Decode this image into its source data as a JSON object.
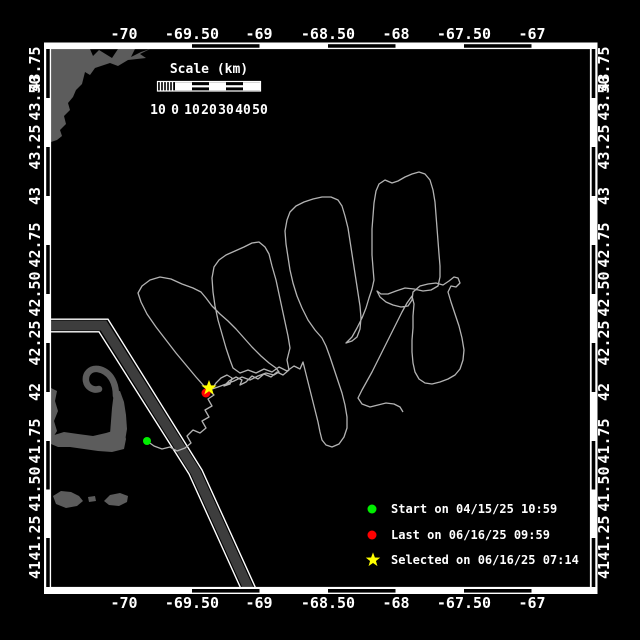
{
  "figure": {
    "bg": "#000000",
    "frame_color": "#ffffff",
    "axes": {
      "lon_labels": [
        {
          "text": "-70",
          "x": 124
        },
        {
          "text": "-69.50",
          "x": 192
        },
        {
          "text": "-69",
          "x": 259
        },
        {
          "text": "-68.50",
          "x": 328
        },
        {
          "text": "-68",
          "x": 396
        },
        {
          "text": "-67.50",
          "x": 464
        },
        {
          "text": "-67",
          "x": 532
        }
      ],
      "lat_labels": [
        {
          "text": "43.75",
          "y": 69
        },
        {
          "text": "43.50",
          "y": 98
        },
        {
          "text": "43.25",
          "y": 147
        },
        {
          "text": "43",
          "y": 196
        },
        {
          "text": "42.75",
          "y": 245
        },
        {
          "text": "42.50",
          "y": 294
        },
        {
          "text": "42.25",
          "y": 343
        },
        {
          "text": "42",
          "y": 392
        },
        {
          "text": "41.75",
          "y": 441
        },
        {
          "text": "41.50",
          "y": 489
        },
        {
          "text": "41.25",
          "y": 538
        },
        {
          "text": "41",
          "y": 570
        }
      ]
    },
    "scalebar": {
      "title": "Scale (km)",
      "tick_labels": [
        {
          "text": "10",
          "x": 158
        },
        {
          "text": "0",
          "x": 175
        },
        {
          "text": "10",
          "x": 192
        },
        {
          "text": "20",
          "x": 209
        },
        {
          "text": "30",
          "x": 226
        },
        {
          "text": "40",
          "x": 243
        },
        {
          "text": "50",
          "x": 260
        }
      ]
    },
    "legend": {
      "items": [
        {
          "marker": "circle",
          "color": "#00ee00",
          "label": "Start on 04/15/25 10:59",
          "y": 509
        },
        {
          "marker": "circle",
          "color": "#ff0000",
          "label": "Last on 06/16/25 09:59",
          "y": 535
        },
        {
          "marker": "star",
          "color": "#ffff00",
          "label": "Selected on 06/16/25 07:14",
          "y": 560
        }
      ]
    }
  },
  "map": {
    "land_color": "#5c5c5c",
    "track_color": "#b3b3b3",
    "lane": {
      "edge_color": "#ffffff",
      "band_color": "#3d3d3d",
      "centerline_color": "#1c1c1c",
      "outer_d": "M 51 319.2 L 108 319.2 L 202 470 L 257 591",
      "inner_d": "M 51 331.8 L 99 331.8 L 189 474 L 242 591",
      "band_d": "M 51 325.5 L 103.5 325.5 L 195.5 472 L 249.5 591"
    },
    "land": {
      "maine": [
        [
          51,
          49
        ],
        [
          90,
          49
        ],
        [
          93,
          56
        ],
        [
          99,
          50
        ],
        [
          112,
          58
        ],
        [
          118,
          49
        ],
        [
          135,
          49
        ],
        [
          131,
          57
        ],
        [
          141,
          52
        ],
        [
          150,
          49
        ],
        [
          140,
          54
        ],
        [
          146,
          58
        ],
        [
          128,
          60
        ],
        [
          118,
          66
        ],
        [
          110,
          63
        ],
        [
          95,
          68
        ],
        [
          90,
          75
        ],
        [
          85,
          72
        ],
        [
          82,
          84
        ],
        [
          76,
          90
        ],
        [
          73,
          97
        ],
        [
          68,
          103
        ],
        [
          70,
          110
        ],
        [
          64,
          116
        ],
        [
          66,
          124
        ],
        [
          60,
          130
        ],
        [
          62,
          136
        ],
        [
          57,
          140
        ],
        [
          51,
          142
        ]
      ],
      "cape_bicep": [
        [
          51,
          436
        ],
        [
          64,
          432
        ],
        [
          78,
          434
        ],
        [
          93,
          436
        ],
        [
          106,
          433
        ],
        [
          116,
          430
        ],
        [
          124,
          431
        ],
        [
          126,
          439
        ],
        [
          124,
          449
        ],
        [
          112,
          452
        ],
        [
          98,
          451
        ],
        [
          84,
          449
        ],
        [
          70,
          447
        ],
        [
          58,
          447
        ],
        [
          51,
          444
        ]
      ],
      "cape_forearm": [
        [
          110,
          434
        ],
        [
          112,
          408
        ],
        [
          114,
          392
        ],
        [
          120,
          391
        ],
        [
          124,
          402
        ],
        [
          126,
          415
        ],
        [
          127,
          429
        ],
        [
          125,
          441
        ],
        [
          117,
          446
        ],
        [
          111,
          441
        ]
      ],
      "mainland_strip": [
        [
          51,
          388
        ],
        [
          57,
          391
        ],
        [
          55,
          401
        ],
        [
          58,
          411
        ],
        [
          54,
          421
        ],
        [
          57,
          431
        ],
        [
          52,
          439
        ],
        [
          51,
          439
        ]
      ],
      "marthas_vineyard": [
        [
          53,
          496
        ],
        [
          61,
          491
        ],
        [
          71,
          492
        ],
        [
          79,
          496
        ],
        [
          83,
          501
        ],
        [
          77,
          506
        ],
        [
          66,
          508
        ],
        [
          56,
          504
        ]
      ],
      "nantucket": [
        [
          104,
          501
        ],
        [
          110,
          495
        ],
        [
          120,
          493
        ],
        [
          128,
          496
        ],
        [
          127,
          502
        ],
        [
          119,
          506
        ],
        [
          109,
          505
        ]
      ],
      "small_isle": [
        [
          88,
          497
        ],
        [
          95,
          496
        ],
        [
          96,
          501
        ],
        [
          89,
          502
        ]
      ]
    },
    "cape_hook_d": "M 116,396 C 116,381 109,371 98,369 C 90,368 85,374 86,381 C 87,387 93,391 99,389",
    "track_points": [
      [
        147,
        441
      ],
      [
        154,
        446
      ],
      [
        162,
        449
      ],
      [
        170,
        447
      ],
      [
        177,
        451
      ],
      [
        185,
        448
      ],
      [
        191,
        443
      ],
      [
        187,
        436
      ],
      [
        193,
        430
      ],
      [
        200,
        433
      ],
      [
        206,
        428
      ],
      [
        202,
        421
      ],
      [
        209,
        417
      ],
      [
        205,
        410
      ],
      [
        212,
        406
      ],
      [
        208,
        399
      ],
      [
        214,
        395
      ],
      [
        210,
        391
      ],
      [
        204,
        386
      ],
      [
        196,
        377
      ],
      [
        186,
        365
      ],
      [
        176,
        353
      ],
      [
        166,
        340
      ],
      [
        156,
        327
      ],
      [
        147,
        314
      ],
      [
        141,
        302
      ],
      [
        138,
        293
      ],
      [
        142,
        286
      ],
      [
        150,
        280
      ],
      [
        160,
        277
      ],
      [
        171,
        279
      ],
      [
        182,
        284
      ],
      [
        193,
        288
      ],
      [
        201,
        292
      ],
      [
        206,
        298
      ],
      [
        212,
        306
      ],
      [
        220,
        314
      ],
      [
        228,
        321
      ],
      [
        236,
        329
      ],
      [
        244,
        338
      ],
      [
        252,
        347
      ],
      [
        261,
        356
      ],
      [
        269,
        363
      ],
      [
        276,
        368
      ],
      [
        279,
        372
      ],
      [
        274,
        375
      ],
      [
        266,
        373
      ],
      [
        258,
        376
      ],
      [
        250,
        380
      ],
      [
        242,
        377
      ],
      [
        234,
        381
      ],
      [
        226,
        384
      ],
      [
        218,
        387
      ],
      [
        212,
        389
      ],
      [
        216,
        383
      ],
      [
        221,
        378
      ],
      [
        227,
        375
      ],
      [
        232,
        378
      ],
      [
        230,
        384
      ],
      [
        224,
        386
      ],
      [
        229,
        381
      ],
      [
        236,
        377
      ],
      [
        242,
        380
      ],
      [
        240,
        385
      ],
      [
        246,
        382
      ],
      [
        252,
        376
      ],
      [
        258,
        379
      ],
      [
        264,
        374
      ],
      [
        271,
        377
      ],
      [
        277,
        372
      ],
      [
        283,
        375
      ],
      [
        289,
        370
      ],
      [
        287,
        360
      ],
      [
        290,
        348
      ],
      [
        288,
        336
      ],
      [
        285,
        322
      ],
      [
        282,
        308
      ],
      [
        279,
        294
      ],
      [
        276,
        280
      ],
      [
        272,
        266
      ],
      [
        269,
        254
      ],
      [
        265,
        247
      ],
      [
        259,
        242
      ],
      [
        252,
        243
      ],
      [
        244,
        247
      ],
      [
        235,
        251
      ],
      [
        226,
        255
      ],
      [
        219,
        260
      ],
      [
        214,
        267
      ],
      [
        212,
        278
      ],
      [
        213,
        292
      ],
      [
        215,
        306
      ],
      [
        218,
        320
      ],
      [
        222,
        334
      ],
      [
        226,
        348
      ],
      [
        230,
        360
      ],
      [
        233,
        368
      ],
      [
        240,
        373
      ],
      [
        248,
        370
      ],
      [
        256,
        373
      ],
      [
        264,
        369
      ],
      [
        272,
        372
      ],
      [
        279,
        367
      ],
      [
        287,
        371
      ],
      [
        294,
        366
      ],
      [
        300,
        369
      ],
      [
        303,
        362
      ],
      [
        306,
        374
      ],
      [
        309,
        386
      ],
      [
        312,
        398
      ],
      [
        315,
        410
      ],
      [
        318,
        422
      ],
      [
        320,
        432
      ],
      [
        322,
        440
      ],
      [
        326,
        445
      ],
      [
        332,
        447
      ],
      [
        339,
        444
      ],
      [
        344,
        437
      ],
      [
        347,
        428
      ],
      [
        347,
        417
      ],
      [
        345,
        405
      ],
      [
        342,
        393
      ],
      [
        338,
        381
      ],
      [
        334,
        369
      ],
      [
        330,
        357
      ],
      [
        326,
        346
      ],
      [
        322,
        338
      ],
      [
        315,
        330
      ],
      [
        308,
        320
      ],
      [
        302,
        308
      ],
      [
        297,
        296
      ],
      [
        293,
        283
      ],
      [
        290,
        270
      ],
      [
        288,
        257
      ],
      [
        286,
        244
      ],
      [
        285,
        231
      ],
      [
        287,
        220
      ],
      [
        290,
        212
      ],
      [
        296,
        206
      ],
      [
        304,
        202
      ],
      [
        313,
        199
      ],
      [
        322,
        197
      ],
      [
        331,
        197
      ],
      [
        338,
        200
      ],
      [
        342,
        206
      ],
      [
        345,
        216
      ],
      [
        348,
        228
      ],
      [
        350,
        241
      ],
      [
        352,
        254
      ],
      [
        354,
        267
      ],
      [
        356,
        280
      ],
      [
        358,
        293
      ],
      [
        360,
        306
      ],
      [
        361,
        318
      ],
      [
        360,
        329
      ],
      [
        357,
        337
      ],
      [
        352,
        341
      ],
      [
        346,
        343
      ],
      [
        352,
        337
      ],
      [
        357,
        328
      ],
      [
        362,
        318
      ],
      [
        366,
        308
      ],
      [
        369,
        298
      ],
      [
        372,
        289
      ],
      [
        374,
        280
      ],
      [
        373,
        268
      ],
      [
        372,
        255
      ],
      [
        372,
        242
      ],
      [
        372,
        229
      ],
      [
        373,
        216
      ],
      [
        374,
        203
      ],
      [
        376,
        191
      ],
      [
        379,
        184
      ],
      [
        385,
        180
      ],
      [
        392,
        183
      ],
      [
        398,
        181
      ],
      [
        405,
        177
      ],
      [
        412,
        174
      ],
      [
        419,
        172
      ],
      [
        425,
        174
      ],
      [
        430,
        180
      ],
      [
        433,
        190
      ],
      [
        435,
        202
      ],
      [
        436,
        215
      ],
      [
        437,
        228
      ],
      [
        438,
        241
      ],
      [
        439,
        254
      ],
      [
        440,
        266
      ],
      [
        440,
        277
      ],
      [
        438,
        286
      ],
      [
        431,
        290
      ],
      [
        423,
        291
      ],
      [
        414,
        289
      ],
      [
        405,
        288
      ],
      [
        396,
        291
      ],
      [
        388,
        294
      ],
      [
        381,
        294
      ],
      [
        377,
        291
      ],
      [
        380,
        297
      ],
      [
        386,
        302
      ],
      [
        393,
        305
      ],
      [
        401,
        307
      ],
      [
        408,
        306
      ],
      [
        412,
        300
      ],
      [
        413,
        292
      ],
      [
        420,
        286
      ],
      [
        428,
        284
      ],
      [
        436,
        283
      ],
      [
        443,
        285
      ],
      [
        449,
        281
      ],
      [
        454,
        277
      ],
      [
        458,
        278
      ],
      [
        460,
        283
      ],
      [
        456,
        287
      ],
      [
        451,
        286
      ],
      [
        448,
        292
      ],
      [
        451,
        302
      ],
      [
        455,
        314
      ],
      [
        459,
        326
      ],
      [
        462,
        338
      ],
      [
        464,
        350
      ],
      [
        463,
        360
      ],
      [
        460,
        369
      ],
      [
        455,
        375
      ],
      [
        448,
        379
      ],
      [
        440,
        382
      ],
      [
        432,
        384
      ],
      [
        425,
        383
      ],
      [
        419,
        379
      ],
      [
        415,
        372
      ],
      [
        413,
        363
      ],
      [
        412,
        352
      ],
      [
        412,
        340
      ],
      [
        413,
        328
      ],
      [
        413,
        316
      ],
      [
        414,
        304
      ],
      [
        412,
        296
      ],
      [
        407,
        303
      ],
      [
        402,
        312
      ],
      [
        397,
        322
      ],
      [
        392,
        332
      ],
      [
        387,
        342
      ],
      [
        382,
        352
      ],
      [
        377,
        362
      ],
      [
        372,
        372
      ],
      [
        367,
        381
      ],
      [
        362,
        390
      ],
      [
        358,
        398
      ],
      [
        362,
        404
      ],
      [
        370,
        407
      ],
      [
        378,
        405
      ],
      [
        386,
        403
      ],
      [
        394,
        404
      ],
      [
        400,
        407
      ],
      [
        403,
        412
      ]
    ],
    "markers": {
      "start": {
        "x": 147,
        "y": 441,
        "r": 4,
        "color": "#00ee00"
      },
      "last": {
        "x": 206,
        "y": 393,
        "r": 4.5,
        "color": "#ff0000"
      },
      "selected": {
        "transform": "translate(209,388)",
        "color": "#ffff00"
      }
    },
    "star_points": "0,-8 2,-2.6 7.6,-2.5 3.1,1.1 4.7,6.5 0,3.2 -4.7,6.5 -3.1,1.1 -7.6,-2.5 -2,-2.6",
    "legend_marker": {
      "start_transform": "translate(372,509)",
      "last_transform": "translate(372,535)",
      "selected_transform": "translate(373,560) scale(0.95)"
    }
  }
}
